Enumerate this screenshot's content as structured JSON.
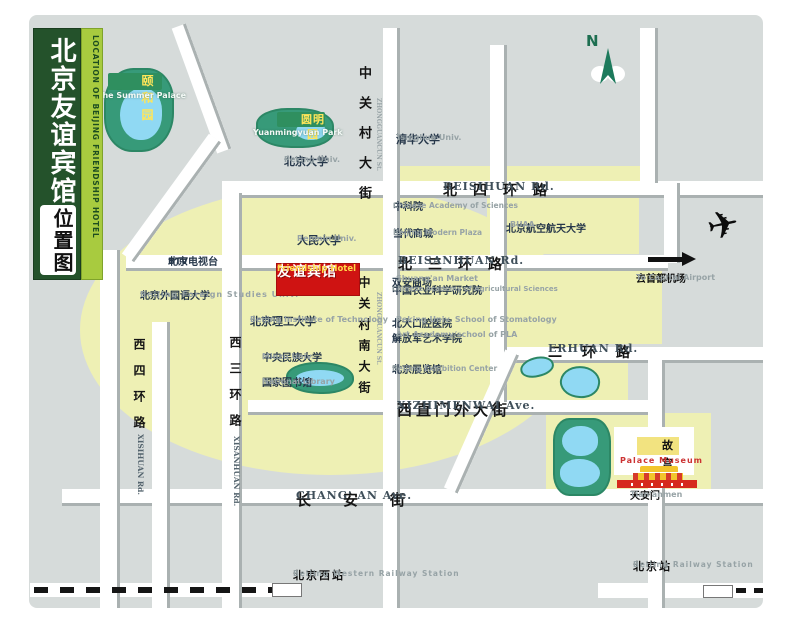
{
  "banner": {
    "title_cn": "北京友谊宾馆",
    "subtitle_cn": "位置图",
    "subtitle_en": "LOCATION OF BEIJING FRIENDSHIP HOTEL"
  },
  "hotel": {
    "name_cn": "友谊宾馆",
    "name_en": "Friendship Hotel"
  },
  "compass": {
    "north_label": "N"
  },
  "airport": {
    "cn": "去首都机场",
    "en": "To Capital Airport"
  },
  "roads": {
    "beisihuan": {
      "cn": "北四环路",
      "en": "BEISIHUAN Rd."
    },
    "beisanhuan": {
      "cn": "北三环路",
      "en": "BEISANHUAN Rd."
    },
    "erhuan": {
      "cn": "二环路",
      "en": "ERHUAN Rd."
    },
    "xizhimenwai": {
      "cn": "西直门外大街",
      "en": "XIZHIMENWAI Ave."
    },
    "changan": {
      "cn": "长安街",
      "en": "CHANG' AN Ave."
    },
    "xisihuan": {
      "cn": "西四环路",
      "en": "XISIHUAN Rd."
    },
    "xisanhuan": {
      "cn": "西三环路",
      "en": "XISANHUAN Rd."
    },
    "zhongguancun_north": {
      "cn": "中关村大街",
      "en": "ZHONGGUANCUN St."
    },
    "zhongguancun_south": {
      "cn": "中关村南大街",
      "en": "ZHONGGUANCUN St."
    }
  },
  "parks": {
    "summer_palace": {
      "cn": "颐和园",
      "en": "The Summer Palace"
    },
    "yuanmingyuan": {
      "cn": "圆明园",
      "en": "Yuanmingyuan Park"
    }
  },
  "places": {
    "peking_univ": {
      "cn": "北京大学",
      "en": "Peking Univ."
    },
    "tsinghua": {
      "cn": "清华大学",
      "en": "Tsinghua Univ."
    },
    "renmin": {
      "cn": "人民大学",
      "en": "Renmin Univ."
    },
    "cas": {
      "cn": "中科院",
      "en": "Chinese Academy of Sciences"
    },
    "modern_plaza": {
      "cn": "当代商城",
      "en": "Beijing Modern Plaza"
    },
    "buaa": {
      "cn": "北京航空航天大学",
      "en": "BUAA"
    },
    "btv": {
      "cn": "北京电视台",
      "en": "BTV"
    },
    "shuangan": {
      "cn": "双安商场",
      "en": "Shuang'an Market"
    },
    "caas": {
      "cn": "中国农业科学研究院",
      "en": "Chinese Academy of Agricultural Sciences"
    },
    "bfsu": {
      "cn": "北京外国语大学",
      "en": "Beijing Foreign Studies Univ."
    },
    "stomatology": {
      "cn": "北大口腔医院",
      "en": "Peking Univ. School of Stomatology"
    },
    "pla_art": {
      "cn": "解放军艺术学院",
      "en": "Art Academy/school of PLA"
    },
    "bit": {
      "cn": "北京理工大学",
      "en": "Beijing Institute of Technology"
    },
    "minzu": {
      "cn": "中央民族大学",
      "en": "Minzu Univ."
    },
    "national_library": {
      "cn": "国家图书馆",
      "en": "National Library"
    },
    "exhibition": {
      "cn": "北京展览馆",
      "en": "Beijing Exhibition Center"
    }
  },
  "landmarks": {
    "palace_museum": {
      "cn": "故宫",
      "en": "Palace Museum"
    },
    "tiananmen": {
      "cn": "天安门",
      "en": "Tian'anmen"
    }
  },
  "stations": {
    "west": {
      "cn": "北京西站",
      "en": "Beijing Western Railway Station"
    },
    "main": {
      "cn": "北京站",
      "en": "Beijing Railway Station"
    }
  },
  "colors": {
    "hotel_red": "#cf1312",
    "park_green": "#379a79",
    "lake_blue": "#90d9f3",
    "block_yellow": "#eef0b4",
    "bg_gray": "#d6dbda",
    "banner_green": "#24522b",
    "banner_light_green": "#a8cb3f",
    "badge_text_yellow": "#ffe65a"
  }
}
